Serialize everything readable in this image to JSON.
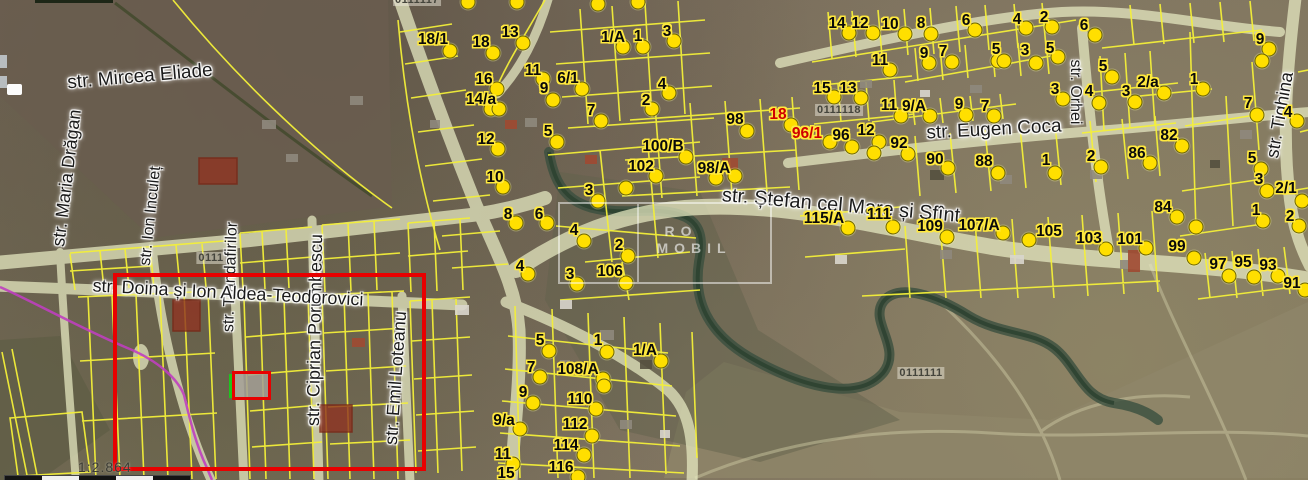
{
  "map": {
    "scale_text": "1:2.864",
    "watermark": {
      "line1": "RO",
      "line2": "MOBIL"
    },
    "colors": {
      "parcel_line": "#f3ef39",
      "dot_fill": "#ffdf00",
      "number_halo": "#ffe93e",
      "red_number": "#d00000",
      "highlight_red": "#e80000",
      "highlight_green": "#1ec41e",
      "road_fill": "#e9ecc4",
      "boundary_magenta": "#bf3fbf",
      "river": "#3a4f3e"
    },
    "cadastral_codes": [
      {
        "text": "0111117",
        "x": 417,
        "y": 0
      },
      {
        "text": "0111118",
        "x": 839,
        "y": 110
      },
      {
        "text": "0111111",
        "x": 921,
        "y": 373
      },
      {
        "text": "0111",
        "x": 211,
        "y": 258
      }
    ],
    "streets": [
      {
        "name": "str. Mircea Eliade",
        "x": 140,
        "y": 77,
        "angle": -5,
        "size": 19
      },
      {
        "name": "str. Maria Drăgan",
        "x": 67,
        "y": 178,
        "angle": -83,
        "size": 18
      },
      {
        "name": "str. Ion Inculeț",
        "x": 151,
        "y": 216,
        "angle": -84,
        "size": 16
      },
      {
        "name": "str. Trandafirilor",
        "x": 231,
        "y": 277,
        "angle": -88,
        "size": 16
      },
      {
        "name": "str. Ciprian Porumbescu",
        "x": 315,
        "y": 330,
        "angle": -89,
        "size": 18
      },
      {
        "name": "str. Emil Loteanu",
        "x": 396,
        "y": 378,
        "angle": -86,
        "size": 18
      },
      {
        "name": "str. Doina și Ion Aldea-Teodorovici",
        "x": 228,
        "y": 293,
        "angle": 3,
        "size": 18
      },
      {
        "name": "str. Ștefan cel Mare și Sfînt",
        "x": 841,
        "y": 206,
        "angle": 5,
        "size": 20
      },
      {
        "name": "str. Eugen Coca",
        "x": 994,
        "y": 130,
        "angle": -3,
        "size": 19
      },
      {
        "name": "str. Orhei",
        "x": 1075,
        "y": 92,
        "angle": 90,
        "size": 16
      },
      {
        "name": "str. Tighina",
        "x": 1280,
        "y": 115,
        "angle": -80,
        "size": 18
      }
    ],
    "parcels": [
      {
        "n": "18/1",
        "x": 433,
        "y": 40,
        "d": [
          [
            450,
            51
          ]
        ]
      },
      {
        "n": "18",
        "x": 481,
        "y": 43,
        "d": [
          [
            493,
            53
          ]
        ]
      },
      {
        "n": "13",
        "x": 510,
        "y": 33,
        "d": [
          [
            523,
            43
          ]
        ]
      },
      {
        "n": "16",
        "x": 484,
        "y": 80,
        "d": [
          [
            497,
            89
          ]
        ]
      },
      {
        "n": "14/a",
        "x": 481,
        "y": 100,
        "d": [
          [
            491,
            109
          ],
          [
            499,
            109
          ]
        ]
      },
      {
        "n": "12",
        "x": 486,
        "y": 140,
        "d": [
          [
            498,
            149
          ]
        ]
      },
      {
        "n": "10",
        "x": 495,
        "y": 178,
        "d": [
          [
            503,
            187
          ]
        ]
      },
      {
        "n": "8",
        "x": 508,
        "y": 215,
        "d": [
          [
            516,
            223
          ]
        ]
      },
      {
        "n": "6",
        "x": 539,
        "y": 215,
        "d": [
          [
            547,
            223
          ]
        ]
      },
      {
        "n": "4",
        "x": 520,
        "y": 267,
        "d": [
          [
            528,
            274
          ]
        ]
      },
      {
        "n": "11",
        "x": 533,
        "y": 71,
        "d": [
          [
            543,
            79
          ]
        ]
      },
      {
        "n": "9",
        "x": 544,
        "y": 89,
        "d": [
          [
            553,
            100
          ]
        ]
      },
      {
        "n": "6/1",
        "x": 568,
        "y": 79,
        "d": [
          [
            582,
            89
          ]
        ]
      },
      {
        "n": "7",
        "x": 591,
        "y": 111,
        "d": [
          [
            601,
            121
          ]
        ]
      },
      {
        "n": "5",
        "x": 548,
        "y": 132,
        "d": [
          [
            557,
            142
          ]
        ]
      },
      {
        "n": "3",
        "x": 589,
        "y": 191,
        "d": [
          [
            598,
            201
          ]
        ]
      },
      {
        "n": "4",
        "x": 574,
        "y": 231,
        "d": [
          [
            584,
            241
          ]
        ]
      },
      {
        "n": "2",
        "x": 619,
        "y": 246,
        "d": [
          [
            628,
            256
          ]
        ]
      },
      {
        "n": "3",
        "x": 570,
        "y": 275,
        "d": [
          [
            577,
            284
          ]
        ]
      },
      {
        "n": "106",
        "x": 610,
        "y": 272,
        "d": [
          [
            626,
            283
          ]
        ]
      },
      {
        "n": "1/A",
        "x": 613,
        "y": 38,
        "d": [
          [
            623,
            47
          ]
        ]
      },
      {
        "n": "1",
        "x": 638,
        "y": 37,
        "d": [
          [
            643,
            47
          ]
        ]
      },
      {
        "n": "3",
        "x": 667,
        "y": 32,
        "d": [
          [
            674,
            41
          ]
        ]
      },
      {
        "n": "4",
        "x": 662,
        "y": 85,
        "d": [
          [
            669,
            93
          ]
        ]
      },
      {
        "n": "2",
        "x": 646,
        "y": 101,
        "d": [
          [
            652,
            109
          ]
        ]
      },
      {
        "n": "98",
        "x": 735,
        "y": 120,
        "d": [
          [
            747,
            131
          ]
        ]
      },
      {
        "n": "18",
        "x": 778,
        "y": 115,
        "red": true,
        "d": [
          [
            791,
            125
          ]
        ]
      },
      {
        "n": "96/1",
        "x": 807,
        "y": 134,
        "red": true,
        "d": [
          [
            830,
            142
          ]
        ]
      },
      {
        "n": "96",
        "x": 841,
        "y": 136,
        "d": [
          [
            852,
            147
          ]
        ]
      },
      {
        "n": "12",
        "x": 866,
        "y": 131,
        "d": [
          [
            879,
            142
          ]
        ]
      },
      {
        "n": "92",
        "x": 899,
        "y": 144,
        "d": [
          [
            908,
            154
          ]
        ]
      },
      {
        "n": "100/B",
        "x": 663,
        "y": 147,
        "d": [
          [
            686,
            157
          ]
        ]
      },
      {
        "n": "102",
        "x": 641,
        "y": 167,
        "d": [
          [
            656,
            176
          ]
        ]
      },
      {
        "n": "98/A",
        "x": 714,
        "y": 169,
        "d": [
          [
            716,
            178
          ],
          [
            735,
            176
          ]
        ]
      },
      {
        "n": "115/A",
        "x": 824,
        "y": 219,
        "d": [
          [
            848,
            228
          ]
        ]
      },
      {
        "n": "111",
        "x": 879,
        "y": 215,
        "d": [
          [
            893,
            227
          ]
        ]
      },
      {
        "n": "90",
        "x": 935,
        "y": 160,
        "d": [
          [
            948,
            168
          ]
        ]
      },
      {
        "n": "88",
        "x": 984,
        "y": 162,
        "d": [
          [
            998,
            173
          ]
        ]
      },
      {
        "n": "1",
        "x": 1046,
        "y": 161,
        "d": [
          [
            1055,
            173
          ]
        ]
      },
      {
        "n": "2",
        "x": 1091,
        "y": 157,
        "d": [
          [
            1101,
            167
          ]
        ]
      },
      {
        "n": "86",
        "x": 1137,
        "y": 154,
        "d": [
          [
            1150,
            163
          ]
        ]
      },
      {
        "n": "82",
        "x": 1169,
        "y": 136,
        "d": [
          [
            1182,
            146
          ]
        ]
      },
      {
        "n": "84",
        "x": 1163,
        "y": 208,
        "d": [
          [
            1177,
            217
          ]
        ]
      },
      {
        "n": "109",
        "x": 930,
        "y": 227,
        "d": [
          [
            947,
            237
          ]
        ]
      },
      {
        "n": "107/A",
        "x": 979,
        "y": 226,
        "d": [
          [
            1003,
            233
          ]
        ]
      },
      {
        "n": "105",
        "x": 1049,
        "y": 232,
        "d": [
          [
            1029,
            240
          ]
        ]
      },
      {
        "n": "103",
        "x": 1089,
        "y": 239,
        "d": [
          [
            1106,
            249
          ]
        ]
      },
      {
        "n": "101",
        "x": 1130,
        "y": 240,
        "d": [
          [
            1146,
            248
          ]
        ]
      },
      {
        "n": "99",
        "x": 1177,
        "y": 247,
        "d": [
          [
            1194,
            258
          ]
        ]
      },
      {
        "n": "97",
        "x": 1218,
        "y": 265,
        "d": [
          [
            1229,
            276
          ]
        ]
      },
      {
        "n": "95",
        "x": 1243,
        "y": 263,
        "d": [
          [
            1254,
            277
          ]
        ]
      },
      {
        "n": "93",
        "x": 1268,
        "y": 266,
        "d": [
          [
            1278,
            276
          ]
        ]
      },
      {
        "n": "91",
        "x": 1292,
        "y": 284,
        "d": [
          [
            1305,
            290
          ]
        ]
      },
      {
        "n": "14",
        "x": 837,
        "y": 24,
        "d": [
          [
            849,
            33
          ]
        ]
      },
      {
        "n": "12",
        "x": 860,
        "y": 24,
        "d": [
          [
            873,
            33
          ]
        ]
      },
      {
        "n": "10",
        "x": 890,
        "y": 25,
        "d": [
          [
            905,
            34
          ]
        ]
      },
      {
        "n": "8",
        "x": 921,
        "y": 24,
        "d": [
          [
            931,
            34
          ]
        ]
      },
      {
        "n": "6",
        "x": 966,
        "y": 21,
        "d": [
          [
            975,
            30
          ]
        ]
      },
      {
        "n": "4",
        "x": 1017,
        "y": 20,
        "d": [
          [
            1026,
            28
          ]
        ]
      },
      {
        "n": "2",
        "x": 1044,
        "y": 18,
        "d": [
          [
            1052,
            27
          ]
        ]
      },
      {
        "n": "9",
        "x": 924,
        "y": 54,
        "d": [
          [
            929,
            63
          ]
        ]
      },
      {
        "n": "7",
        "x": 943,
        "y": 52,
        "d": [
          [
            952,
            62
          ]
        ]
      },
      {
        "n": "5",
        "x": 996,
        "y": 50,
        "d": [
          [
            998,
            61
          ],
          [
            1004,
            61
          ]
        ]
      },
      {
        "n": "3",
        "x": 1025,
        "y": 51,
        "d": [
          [
            1036,
            63
          ]
        ]
      },
      {
        "n": "5",
        "x": 1050,
        "y": 49,
        "d": [
          [
            1058,
            57
          ]
        ]
      },
      {
        "n": "11",
        "x": 880,
        "y": 61,
        "d": [
          [
            890,
            70
          ]
        ]
      },
      {
        "n": "15",
        "x": 822,
        "y": 89,
        "d": [
          [
            834,
            97
          ]
        ]
      },
      {
        "n": "13",
        "x": 848,
        "y": 89,
        "d": [
          [
            861,
            98
          ]
        ]
      },
      {
        "n": "11",
        "x": 889,
        "y": 106,
        "d": [
          [
            901,
            116
          ]
        ]
      },
      {
        "n": "9/A",
        "x": 914,
        "y": 107,
        "d": [
          [
            930,
            116
          ]
        ]
      },
      {
        "n": "9",
        "x": 959,
        "y": 105,
        "d": [
          [
            966,
            115
          ]
        ]
      },
      {
        "n": "7",
        "x": 985,
        "y": 107,
        "d": [
          [
            994,
            116
          ]
        ]
      },
      {
        "n": "3",
        "x": 1055,
        "y": 90,
        "d": [
          [
            1063,
            99
          ]
        ]
      },
      {
        "n": "6",
        "x": 1084,
        "y": 26,
        "d": [
          [
            1095,
            35
          ]
        ]
      },
      {
        "n": "5",
        "x": 1103,
        "y": 67,
        "d": [
          [
            1112,
            77
          ]
        ]
      },
      {
        "n": "4",
        "x": 1089,
        "y": 92,
        "d": [
          [
            1099,
            103
          ]
        ]
      },
      {
        "n": "3",
        "x": 1126,
        "y": 92,
        "d": [
          [
            1135,
            102
          ]
        ]
      },
      {
        "n": "2/a",
        "x": 1148,
        "y": 83,
        "d": [
          [
            1164,
            93
          ]
        ]
      },
      {
        "n": "1",
        "x": 1194,
        "y": 80,
        "d": [
          [
            1203,
            89
          ]
        ]
      },
      {
        "n": "9",
        "x": 1260,
        "y": 40,
        "d": [
          [
            1269,
            49
          ],
          [
            1262,
            61
          ]
        ]
      },
      {
        "n": "7",
        "x": 1248,
        "y": 104,
        "d": [
          [
            1257,
            115
          ]
        ]
      },
      {
        "n": "4",
        "x": 1288,
        "y": 113,
        "d": [
          [
            1297,
            121
          ]
        ]
      },
      {
        "n": "5",
        "x": 1252,
        "y": 159,
        "d": [
          [
            1261,
            169
          ]
        ]
      },
      {
        "n": "3",
        "x": 1259,
        "y": 180,
        "d": [
          [
            1267,
            191
          ]
        ]
      },
      {
        "n": "2/1",
        "x": 1286,
        "y": 189,
        "d": [
          [
            1302,
            201
          ]
        ]
      },
      {
        "n": "1",
        "x": 1256,
        "y": 211,
        "d": [
          [
            1263,
            221
          ]
        ]
      },
      {
        "n": "2",
        "x": 1290,
        "y": 217,
        "d": [
          [
            1299,
            226
          ]
        ]
      },
      {
        "n": "5",
        "x": 540,
        "y": 341,
        "d": [
          [
            549,
            351
          ]
        ]
      },
      {
        "n": "1",
        "x": 598,
        "y": 341,
        "d": [
          [
            607,
            352
          ]
        ]
      },
      {
        "n": "1/A",
        "x": 645,
        "y": 351,
        "d": [
          [
            661,
            361
          ]
        ]
      },
      {
        "n": "7",
        "x": 531,
        "y": 368,
        "d": [
          [
            540,
            377
          ]
        ]
      },
      {
        "n": "108/A",
        "x": 578,
        "y": 370,
        "d": [
          [
            603,
            379
          ],
          [
            604,
            386
          ]
        ]
      },
      {
        "n": "9",
        "x": 523,
        "y": 393,
        "d": [
          [
            533,
            403
          ]
        ]
      },
      {
        "n": "110",
        "x": 580,
        "y": 400,
        "d": [
          [
            596,
            409
          ]
        ]
      },
      {
        "n": "9/a",
        "x": 504,
        "y": 421,
        "d": [
          [
            520,
            429
          ]
        ]
      },
      {
        "n": "112",
        "x": 575,
        "y": 425,
        "d": [
          [
            592,
            436
          ]
        ]
      },
      {
        "n": "114",
        "x": 566,
        "y": 446,
        "d": [
          [
            584,
            455
          ]
        ]
      },
      {
        "n": "11",
        "x": 503,
        "y": 455,
        "d": [
          [
            513,
            464
          ]
        ]
      },
      {
        "n": "116",
        "x": 561,
        "y": 468,
        "d": [
          [
            578,
            477
          ]
        ]
      },
      {
        "n": "15",
        "x": 506,
        "y": 474,
        "d": []
      }
    ],
    "extra_dots": [
      [
        874,
        153
      ],
      [
        626,
        188
      ],
      [
        1196,
        227
      ],
      [
        468,
        2
      ],
      [
        517,
        2
      ],
      [
        598,
        4
      ],
      [
        638,
        2
      ]
    ],
    "highlight": {
      "outer": {
        "x": 113,
        "y": 273,
        "w": 313,
        "h": 198
      },
      "inner": {
        "x": 232,
        "y": 371,
        "w": 39,
        "h": 29
      },
      "green_edge": {
        "x": 229,
        "y": 374,
        "h": 24
      }
    },
    "watermark_box": {
      "x": 558,
      "y": 202,
      "w": 210,
      "h": 78,
      "divider_x": 77,
      "line1_pos": [
        681,
        231
      ],
      "line2_pos": [
        694,
        248
      ]
    },
    "scale_label_pos": [
      78,
      459
    ],
    "scale_bar": {
      "x": 4,
      "y": 475,
      "segments": 5,
      "segment_width": 37,
      "height": 8
    }
  }
}
